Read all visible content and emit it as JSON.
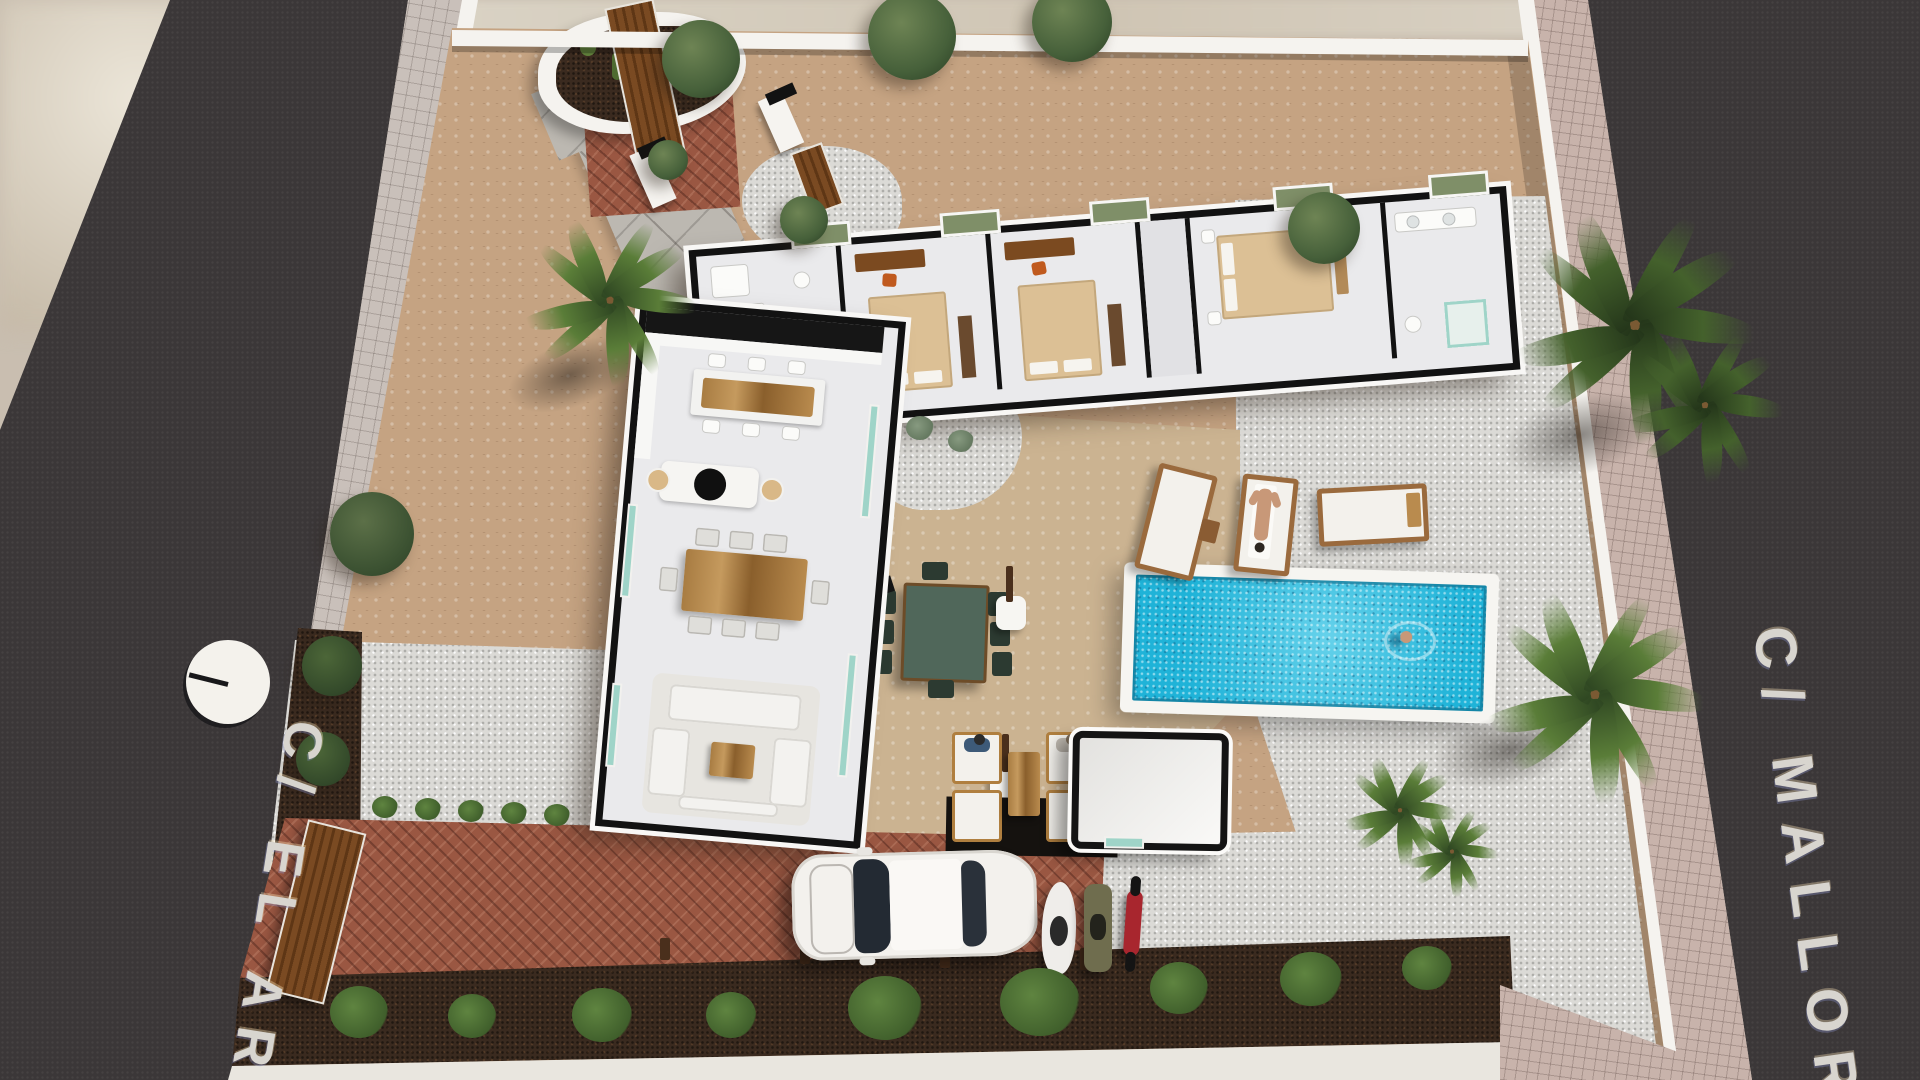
{
  "scene": {
    "kind": "aerial-3d-villa-site-render",
    "streets": {
      "left": {
        "name_label": "C/ EL AR",
        "surface": "asphalt",
        "marker_icon": "clock-disc-icon"
      },
      "right": {
        "name_label": "C/ MALLOR",
        "surface": "asphalt"
      }
    },
    "palette": {
      "asphalt": "#3b3738",
      "sidewalk_left": "#c9c0ba",
      "sidewalk_right": "#c8b3ab",
      "perimeter_wall": "#f5f3ef",
      "cobble_tan": "#c5a382",
      "cobble_light": "#cbb391",
      "gravel": "#dbdad6",
      "brick_drive": "#9a5742",
      "mulch": "#3a2a1f",
      "pool_water": "#1fb3d8",
      "pool_deck": "#f6f5f1",
      "house_wall": "#121212",
      "house_floor": "#eaeaec",
      "wood": "#b9854a",
      "palm_green": "#5a7d38",
      "shrub_green": "#4e7434",
      "car_body": "#f3f1ed",
      "street_text": "#d8d5cf"
    },
    "inventory": {
      "beds": 3,
      "sun_loungers": 3,
      "scooters": 3,
      "cars": 1,
      "people": [
        "standing-at-entry",
        "sunbathing-on-lounger",
        "swimming-in-pool",
        "seated-in-lounge-1",
        "seated-in-lounge-2"
      ],
      "objects": [
        "open-roof-villa-floorplan",
        "kitchen-island",
        "dining-table",
        "living-sofas",
        "swimming-pool",
        "outdoor-dining-set",
        "outdoor-lounge-set",
        "pool-house",
        "outdoor-showers",
        "cactus-planter",
        "entry-gate",
        "wooden-driveway-gate",
        "palm-trees",
        "olive-trees",
        "shrub-row",
        "brick-driveway",
        "gravel-beds",
        "stone-courtyard-wall"
      ]
    }
  }
}
